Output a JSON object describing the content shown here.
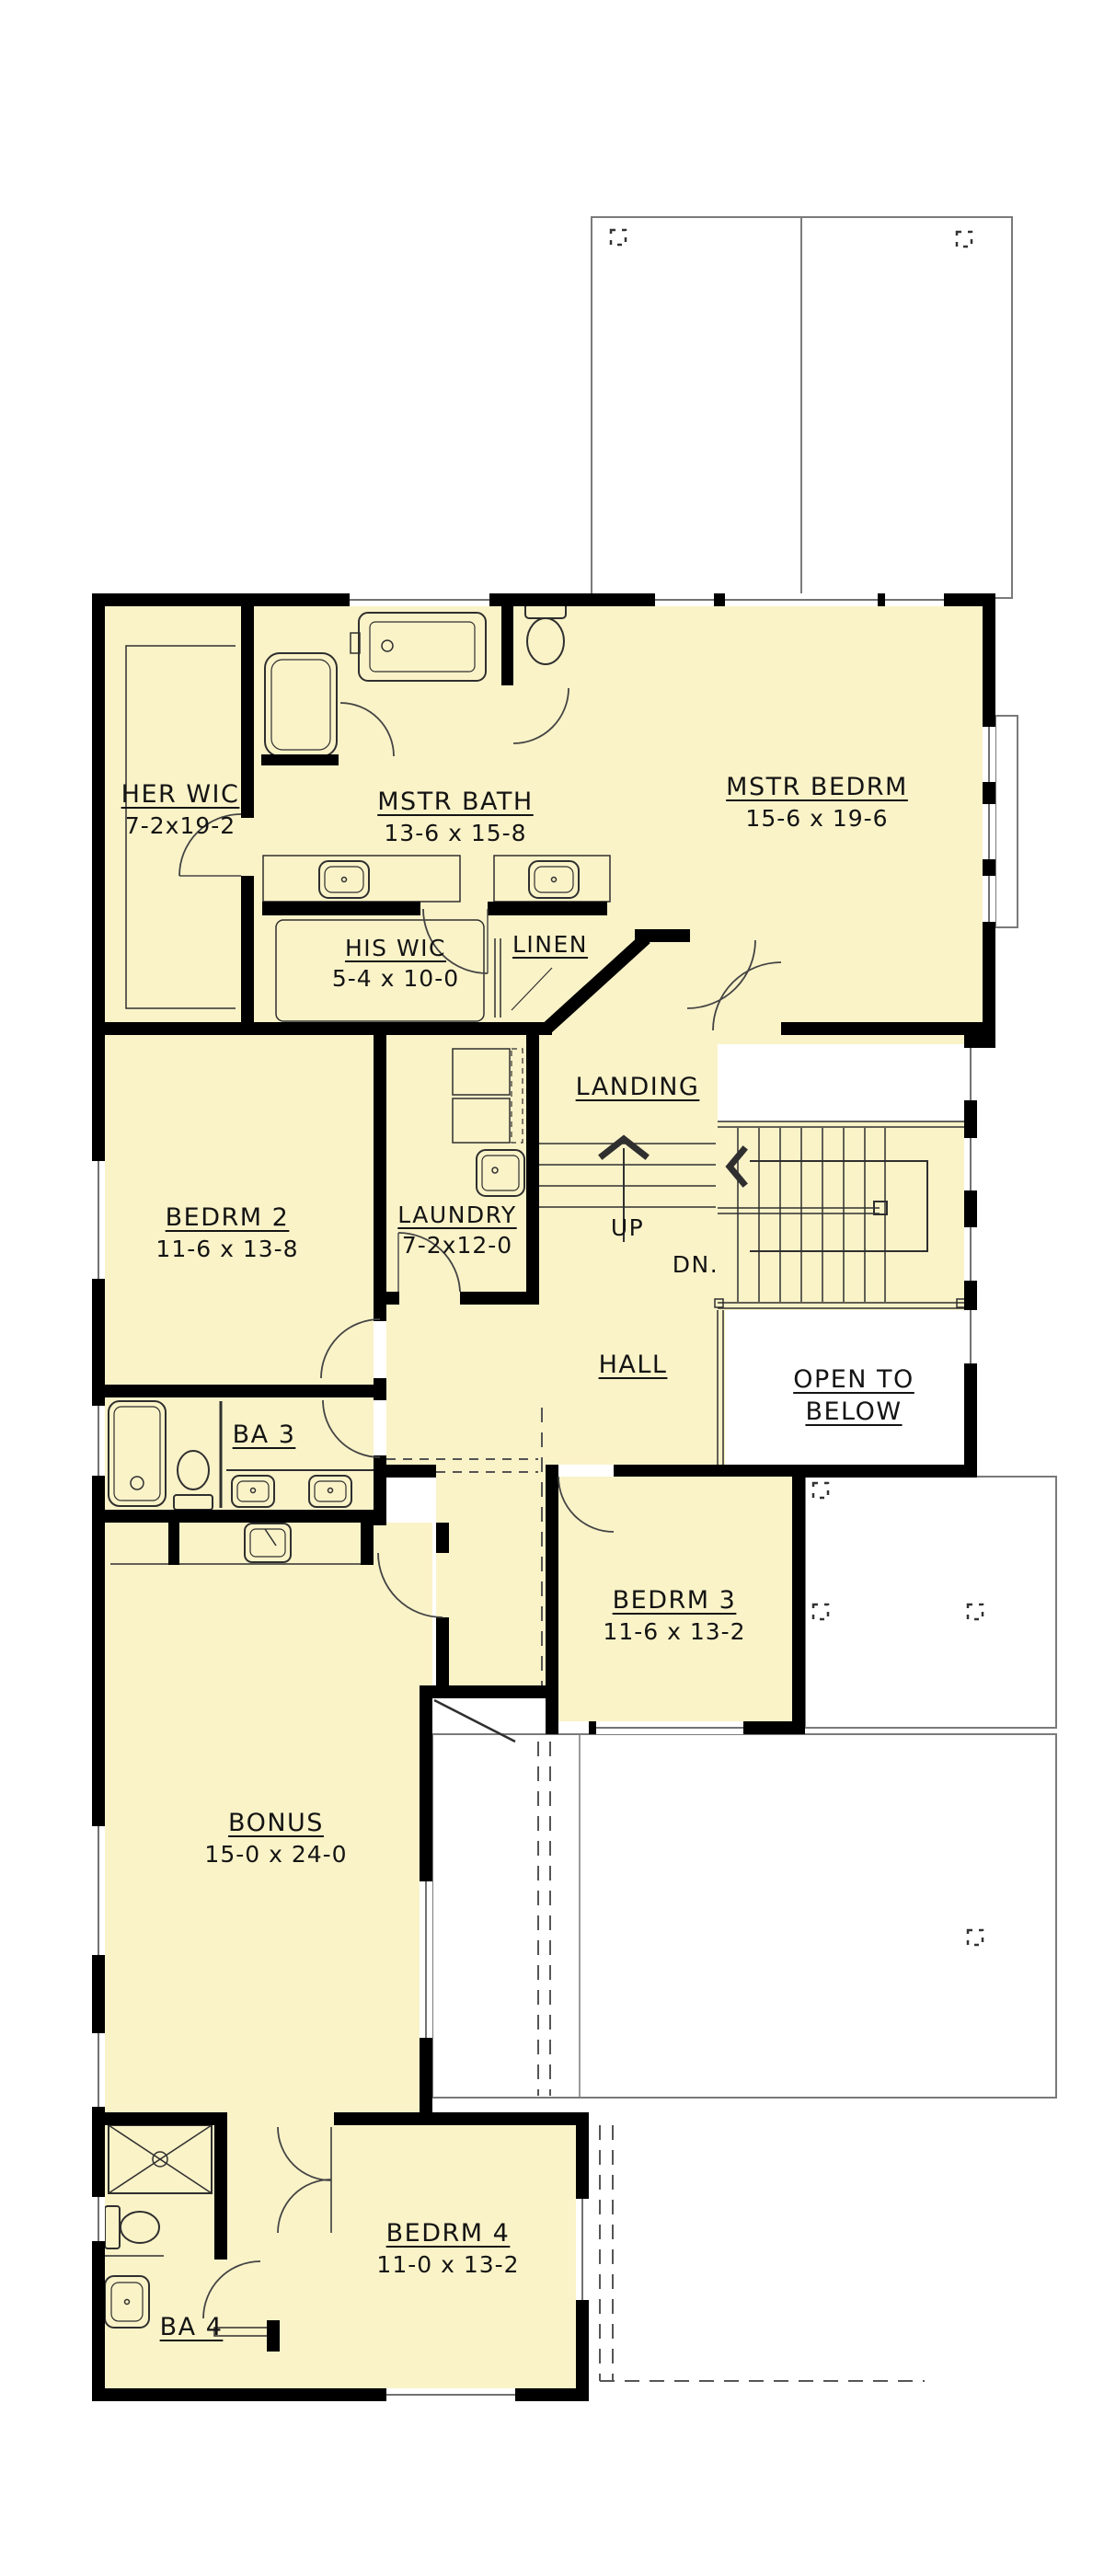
{
  "plan": {
    "type": "floor-plan",
    "colors": {
      "floor": "#FAF3C8",
      "wall": "#000000",
      "line": "#2F2F2F",
      "roof_outline": "#7A7A7A"
    },
    "rooms": {
      "her_wic": {
        "name": "HER WIC",
        "dims": "7-2x19-2"
      },
      "mstr_bath": {
        "name": "MSTR BATH",
        "dims": "13-6 x 15-8"
      },
      "mstr_bedrm": {
        "name": "MSTR BEDRM",
        "dims": "15-6 x 19-6"
      },
      "his_wic": {
        "name": "HIS WIC",
        "dims": "5-4 x 10-0"
      },
      "linen": {
        "name": "LINEN"
      },
      "landing": {
        "name": "LANDING"
      },
      "bedrm2": {
        "name": "BEDRM 2",
        "dims": "11-6 x 13-8"
      },
      "laundry": {
        "name": "LAUNDRY",
        "dims": "7-2x12-0"
      },
      "hall": {
        "name": "HALL"
      },
      "open_below": {
        "name": "OPEN TO BELOW"
      },
      "ba3": {
        "name": "BA 3"
      },
      "bedrm3": {
        "name": "BEDRM 3",
        "dims": "11-6 x 13-2"
      },
      "bonus": {
        "name": "BONUS",
        "dims": "15-0 x 24-0"
      },
      "bedrm4": {
        "name": "BEDRM 4",
        "dims": "11-0 x 13-2"
      },
      "ba4": {
        "name": "BA 4"
      }
    },
    "stairs": {
      "up": "UP",
      "down": "DN."
    }
  }
}
